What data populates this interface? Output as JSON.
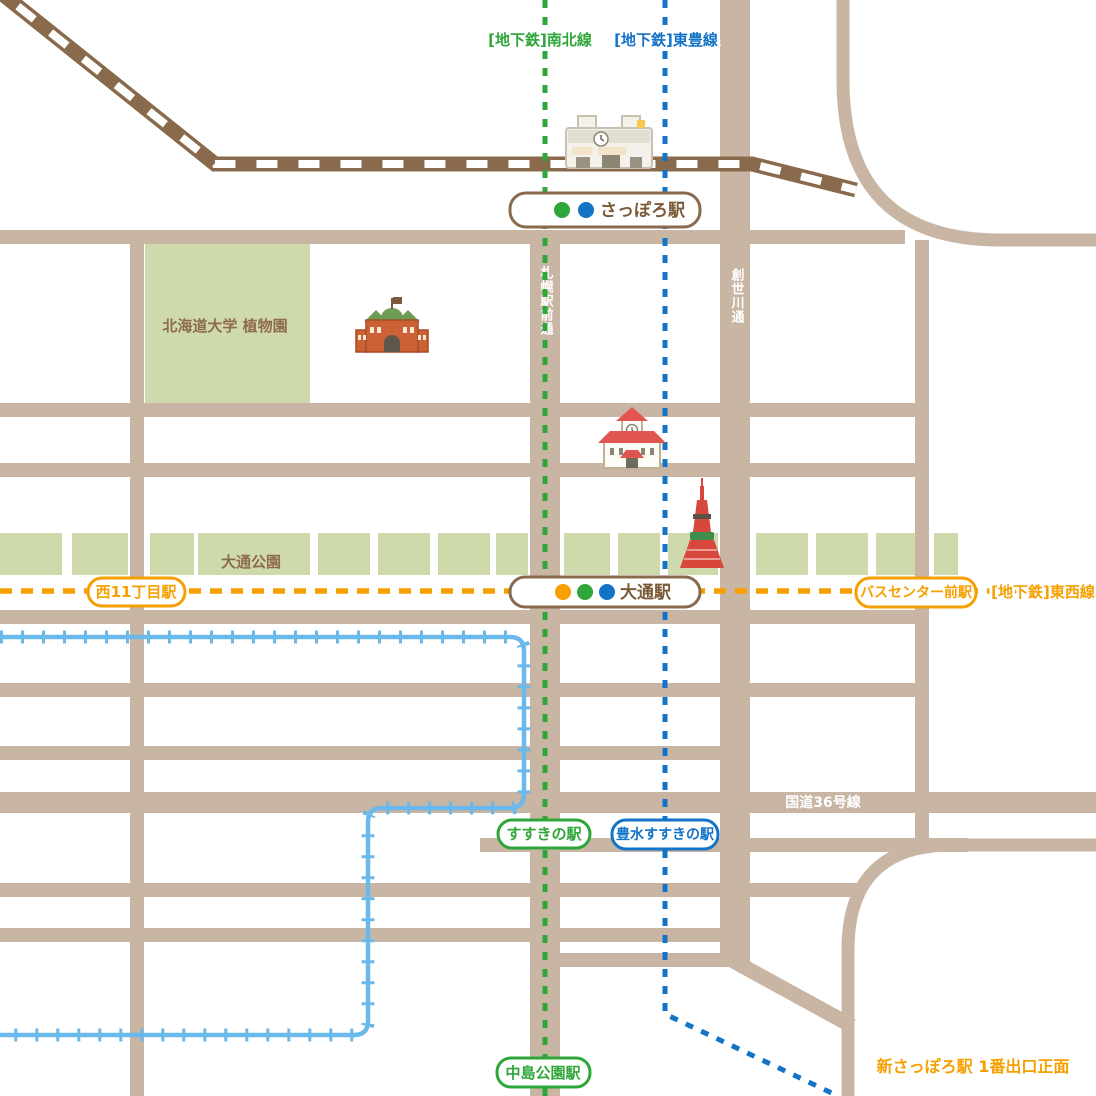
{
  "legend": {
    "namboku_label": "[地下鉄]南北線",
    "toho_label": "[地下鉄]東豊線",
    "tozai_label": "[地下鉄]東西線"
  },
  "stations": {
    "sapporo": {
      "label": "さっぽろ駅",
      "line_dots": [
        "green",
        "blue"
      ]
    },
    "odori": {
      "label": "大通駅",
      "line_dots": [
        "orange",
        "green",
        "blue"
      ]
    },
    "nishi11chome": {
      "label": "西11丁目駅"
    },
    "bus_center_mae": {
      "label": "バスセンター前駅"
    },
    "susukino": {
      "label": "すすきの駅"
    },
    "hosui_susukino": {
      "label": "豊水すすきの駅"
    },
    "nakajima_koen": {
      "label": "中島公園駅"
    }
  },
  "streets": {
    "sapporo_ekimae_dori": "札幌駅前通",
    "soseigawa_dori": "創世川通",
    "route36": "国道36号線"
  },
  "places": {
    "botanical_garden": "北海道大学 植物園",
    "odori_park": "大通公園"
  },
  "note": {
    "shin_sapporo": "新さっぽろ駅 1番出口正面"
  },
  "colors": {
    "namboku_green": "#2fa639",
    "toho_blue": "#1273c7",
    "tozai_orange": "#f5a000",
    "streetcar_blue": "#6bb8ea",
    "road_tan": "#c8b5a3",
    "railway_brown": "#8a6a4c",
    "park_green": "#ced9ac",
    "station_text_brown": "#7b5a3a"
  }
}
